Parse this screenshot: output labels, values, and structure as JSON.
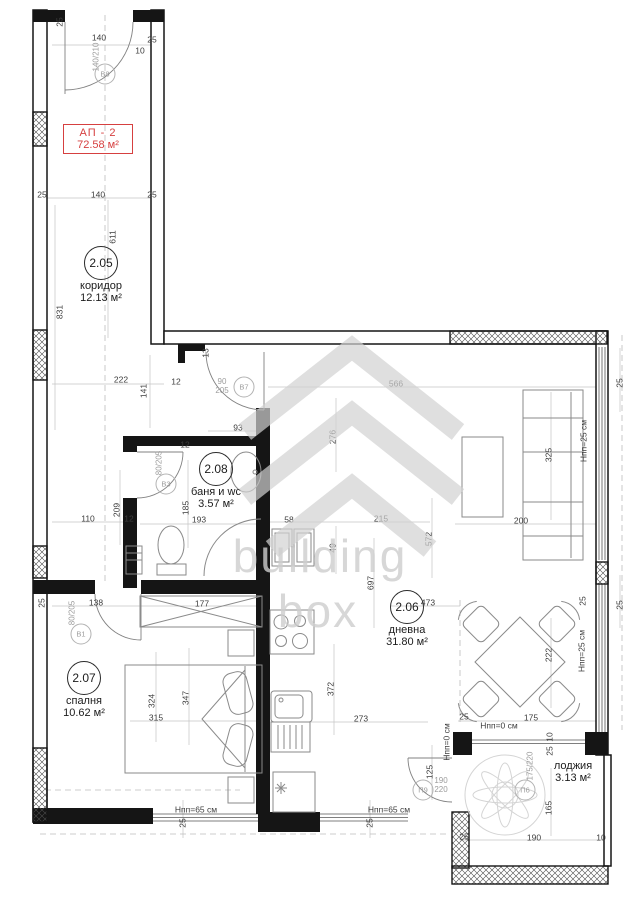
{
  "colors": {
    "accent_red": "#d64040",
    "wall": "#151515",
    "dim_text": "#3d3d3d",
    "tag_gray": "#9c9c9c"
  },
  "apartment_tag": {
    "id": "АП - 2",
    "area": "72.58 м²"
  },
  "watermark": {
    "line1": "building",
    "line2": "box"
  },
  "rooms": [
    {
      "num": "2.05",
      "name": "коридор",
      "area": "12.13 м²",
      "x": 101,
      "y": 263
    },
    {
      "num": "2.08",
      "name": "баня и wc",
      "area": "3.57 м²",
      "x": 216,
      "y": 469
    },
    {
      "num": "2.07",
      "name": "спалня",
      "area": "10.62 м²",
      "x": 84,
      "y": 678
    },
    {
      "num": "2.06",
      "name": "дневна",
      "area": "31.80 м²",
      "x": 407,
      "y": 607
    },
    {
      "num": "",
      "name": "лоджия",
      "area": "3.13 м²",
      "x": 573,
      "y": 766
    }
  ],
  "tags": [
    {
      "id": "В8",
      "size": "140/210",
      "cx": 105,
      "cy": 74,
      "sx": 97,
      "sy": 57,
      "rot": true,
      "stacked": false
    },
    {
      "id": "В7",
      "size": "90/205",
      "cx": 244,
      "cy": 387,
      "sx": 222,
      "sy": 387,
      "rot": false,
      "stacked": true
    },
    {
      "id": "В3",
      "size": "80/205",
      "cx": 166,
      "cy": 484,
      "sx": 160,
      "sy": 463,
      "rot": true,
      "stacked": false
    },
    {
      "id": "В1",
      "size": "80/205",
      "cx": 81,
      "cy": 634,
      "sx": 73,
      "sy": 613,
      "rot": true,
      "stacked": false
    },
    {
      "id": "П9",
      "size": "190/220",
      "cx": 423,
      "cy": 790,
      "sx": 441,
      "sy": 786,
      "rot": false,
      "stacked": true
    },
    {
      "id": "П6",
      "size": "175/220",
      "cx": 525,
      "cy": 790,
      "sx": 531,
      "sy": 766,
      "rot": true,
      "stacked": false
    }
  ],
  "dims": [
    {
      "t": "25",
      "x": 60,
      "y": 22,
      "r": 1
    },
    {
      "t": "140",
      "x": 99,
      "y": 38,
      "r": 0
    },
    {
      "t": "25",
      "x": 152,
      "y": 40,
      "r": 0
    },
    {
      "t": "10",
      "x": 140,
      "y": 51,
      "r": 0
    },
    {
      "t": "25",
      "x": 42,
      "y": 195,
      "r": 0
    },
    {
      "t": "140",
      "x": 98,
      "y": 195,
      "r": 0
    },
    {
      "t": "25",
      "x": 152,
      "y": 195,
      "r": 0
    },
    {
      "t": "611",
      "x": 113,
      "y": 237,
      "r": 1
    },
    {
      "t": "831",
      "x": 60,
      "y": 312,
      "r": 1
    },
    {
      "t": "222",
      "x": 121,
      "y": 380,
      "r": 0
    },
    {
      "t": "141",
      "x": 144,
      "y": 391,
      "r": 1
    },
    {
      "t": "12",
      "x": 176,
      "y": 382,
      "r": 0
    },
    {
      "t": "13",
      "x": 206,
      "y": 353,
      "r": 1
    },
    {
      "t": "566",
      "x": 396,
      "y": 384,
      "r": 0
    },
    {
      "t": "93",
      "x": 238,
      "y": 428,
      "r": 0
    },
    {
      "t": "276",
      "x": 333,
      "y": 437,
      "r": 1
    },
    {
      "t": "25",
      "x": 620,
      "y": 383,
      "r": 1
    },
    {
      "t": "325",
      "x": 549,
      "y": 455,
      "r": 1
    },
    {
      "t": "Нпп=25 см",
      "x": 584,
      "y": 441,
      "r": 1
    },
    {
      "t": "200",
      "x": 521,
      "y": 521,
      "r": 0
    },
    {
      "t": "110",
      "x": 88,
      "y": 519,
      "r": 0
    },
    {
      "t": "209",
      "x": 117,
      "y": 510,
      "r": 1
    },
    {
      "t": "12",
      "x": 129,
      "y": 519,
      "r": 0
    },
    {
      "t": "12",
      "x": 185,
      "y": 445,
      "r": 0
    },
    {
      "t": "185",
      "x": 186,
      "y": 508,
      "r": 1
    },
    {
      "t": "193",
      "x": 199,
      "y": 520,
      "r": 0
    },
    {
      "t": "58",
      "x": 289,
      "y": 520,
      "r": 0
    },
    {
      "t": "49",
      "x": 333,
      "y": 548,
      "r": 1
    },
    {
      "t": "215",
      "x": 381,
      "y": 519,
      "r": 0
    },
    {
      "t": "572",
      "x": 429,
      "y": 539,
      "r": 1
    },
    {
      "t": "697",
      "x": 371,
      "y": 583,
      "r": 1
    },
    {
      "t": "473",
      "x": 428,
      "y": 603,
      "r": 0
    },
    {
      "t": "25",
      "x": 42,
      "y": 603,
      "r": 1
    },
    {
      "t": "138",
      "x": 96,
      "y": 603,
      "r": 0
    },
    {
      "t": "177",
      "x": 202,
      "y": 604,
      "r": 0
    },
    {
      "t": "315",
      "x": 156,
      "y": 718,
      "r": 0
    },
    {
      "t": "324",
      "x": 152,
      "y": 701,
      "r": 1
    },
    {
      "t": "347",
      "x": 186,
      "y": 698,
      "r": 1
    },
    {
      "t": "372",
      "x": 331,
      "y": 689,
      "r": 1
    },
    {
      "t": "273",
      "x": 361,
      "y": 719,
      "r": 0
    },
    {
      "t": "222",
      "x": 549,
      "y": 655,
      "r": 1
    },
    {
      "t": "175",
      "x": 531,
      "y": 718,
      "r": 0
    },
    {
      "t": "25",
      "x": 464,
      "y": 717,
      "r": 0
    },
    {
      "t": "Нпп=0 см",
      "x": 499,
      "y": 726,
      "r": 0
    },
    {
      "t": "Нпп=25 см",
      "x": 582,
      "y": 651,
      "r": 1
    },
    {
      "t": "25",
      "x": 583,
      "y": 601,
      "r": 1
    },
    {
      "t": "25",
      "x": 620,
      "y": 605,
      "r": 1
    },
    {
      "t": "Нпп=65 см",
      "x": 196,
      "y": 810,
      "r": 0
    },
    {
      "t": "Нпп=65 см",
      "x": 389,
      "y": 810,
      "r": 0
    },
    {
      "t": "25",
      "x": 183,
      "y": 823,
      "r": 1
    },
    {
      "t": "25",
      "x": 370,
      "y": 823,
      "r": 1
    },
    {
      "t": "Нпп=0 см",
      "x": 447,
      "y": 742,
      "r": 1
    },
    {
      "t": "125",
      "x": 430,
      "y": 772,
      "r": 1
    },
    {
      "t": "10",
      "x": 550,
      "y": 737,
      "r": 1
    },
    {
      "t": "25",
      "x": 550,
      "y": 751,
      "r": 1
    },
    {
      "t": "165",
      "x": 549,
      "y": 808,
      "r": 1
    },
    {
      "t": "190",
      "x": 534,
      "y": 838,
      "r": 0
    },
    {
      "t": "25",
      "x": 464,
      "y": 837,
      "r": 0
    },
    {
      "t": "10",
      "x": 601,
      "y": 838,
      "r": 0
    }
  ]
}
